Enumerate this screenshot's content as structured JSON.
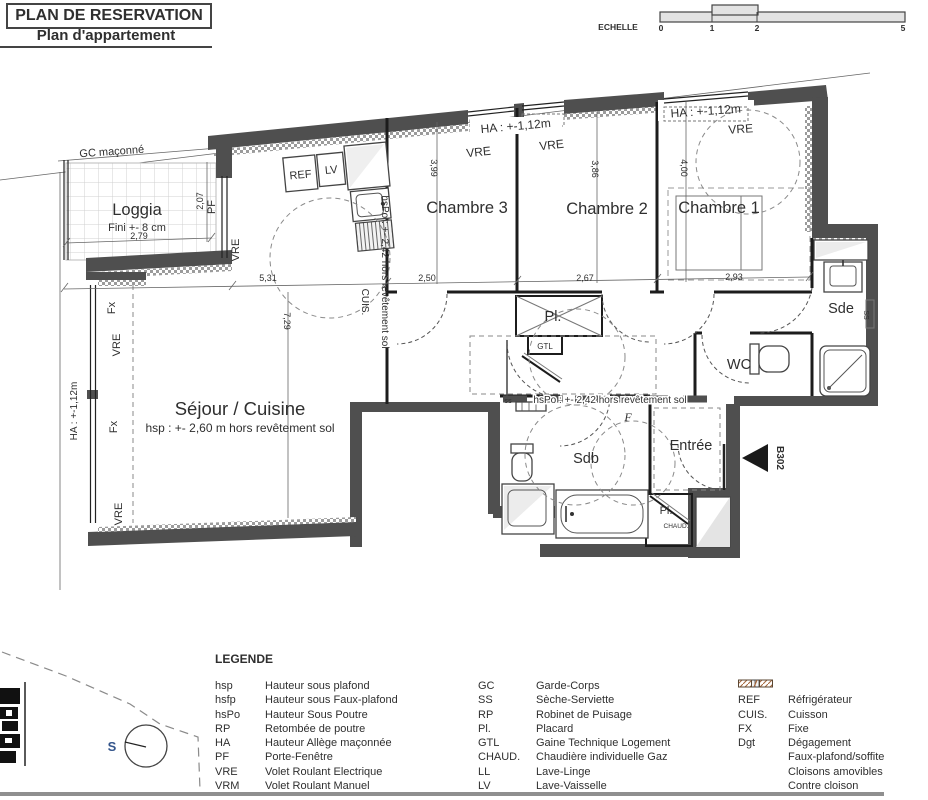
{
  "title": {
    "main": "PLAN DE RESERVATION",
    "subtitle": "Plan d'appartement"
  },
  "scale_bar": {
    "label": "ECHELLE",
    "tick0": "0",
    "tick1": "1",
    "tick2": "2",
    "tick5": "5"
  },
  "plan": {
    "rooms": {
      "loggia": "Loggia",
      "loggia_note": "Fini +- 8 cm",
      "sejour": "Séjour / Cuisine",
      "sejour_note": "hsp : +- 2,60 m hors revêtement sol",
      "chambre3": "Chambre 3",
      "chambre2": "Chambre 2",
      "chambre1": "Chambre 1",
      "sde": "Sde",
      "wc": "WC",
      "sdb": "Sdb",
      "entree": "Entrée",
      "placard": "Pl.",
      "gtl": "GTL",
      "chaud": "CHAUD."
    },
    "dims": {
      "loggia_w": "2,79",
      "loggia_h": "2,07",
      "sejour_w": "5,31",
      "sejour_h": "7,29",
      "ch3_h": "3,99",
      "ch3_w": "2,50",
      "ch2_h": "3,86",
      "ch2_w": "2,67",
      "ch1_h": "4,00",
      "ch1_w": "2,93"
    },
    "tags": {
      "gc": "GC maçonné",
      "ha": "HA : +-1,12m",
      "hspo": "hsPo : +- 2,42 hors revêtement sol",
      "vre": "VRE",
      "fx": "Fx",
      "pf": "PF",
      "cuis": "CUIS.",
      "ref": "REF",
      "lv": "LV",
      "ss_radiator": "ss",
      "ss_sde": "SS",
      "f_tag": "F",
      "unit": "B302",
      "compass_s": "S"
    }
  },
  "legend": {
    "heading": "LEGENDE",
    "col1": [
      {
        "abbr": "hsp",
        "label": "Hauteur sous plafond"
      },
      {
        "abbr": "hsfp",
        "label": "Hauteur sous Faux-plafond"
      },
      {
        "abbr": "hsPo",
        "label": "Hauteur Sous Poutre"
      },
      {
        "abbr": "RP",
        "label": "Retombée de poutre"
      },
      {
        "abbr": "HA",
        "label": "Hauteur Allège maçonnée"
      },
      {
        "abbr": "PF",
        "label": "Porte-Fenêtre"
      },
      {
        "abbr": "VRE",
        "label": "Volet Roulant Electrique"
      },
      {
        "abbr": "VRM",
        "label": "Volet Roulant Manuel"
      }
    ],
    "col2": [
      {
        "abbr": "GC",
        "label": "Garde-Corps"
      },
      {
        "abbr": "SS",
        "label": "Sèche-Serviette"
      },
      {
        "abbr": "RP",
        "label": "Robinet de Puisage"
      },
      {
        "abbr": "Pl.",
        "label": "Placard"
      },
      {
        "abbr": "GTL",
        "label": "Gaine Technique Logement"
      },
      {
        "abbr": "CHAUD.",
        "label": "Chaudière individuelle Gaz"
      },
      {
        "abbr": "LL",
        "label": "Lave-Linge"
      },
      {
        "abbr": "LV",
        "label": "Lave-Vaisselle"
      }
    ],
    "col3": [
      {
        "abbr": "REF",
        "label": "Réfrigérateur"
      },
      {
        "abbr": "CUIS.",
        "label": "Cuisson"
      },
      {
        "abbr": "FX",
        "label": "Fixe"
      },
      {
        "abbr": "Dgt",
        "label": "Dégagement"
      }
    ],
    "col3_swatches": [
      {
        "label": "Faux-plafond/soffite"
      },
      {
        "label": "Cloisons amovibles"
      },
      {
        "label": "Contre cloison"
      }
    ]
  }
}
